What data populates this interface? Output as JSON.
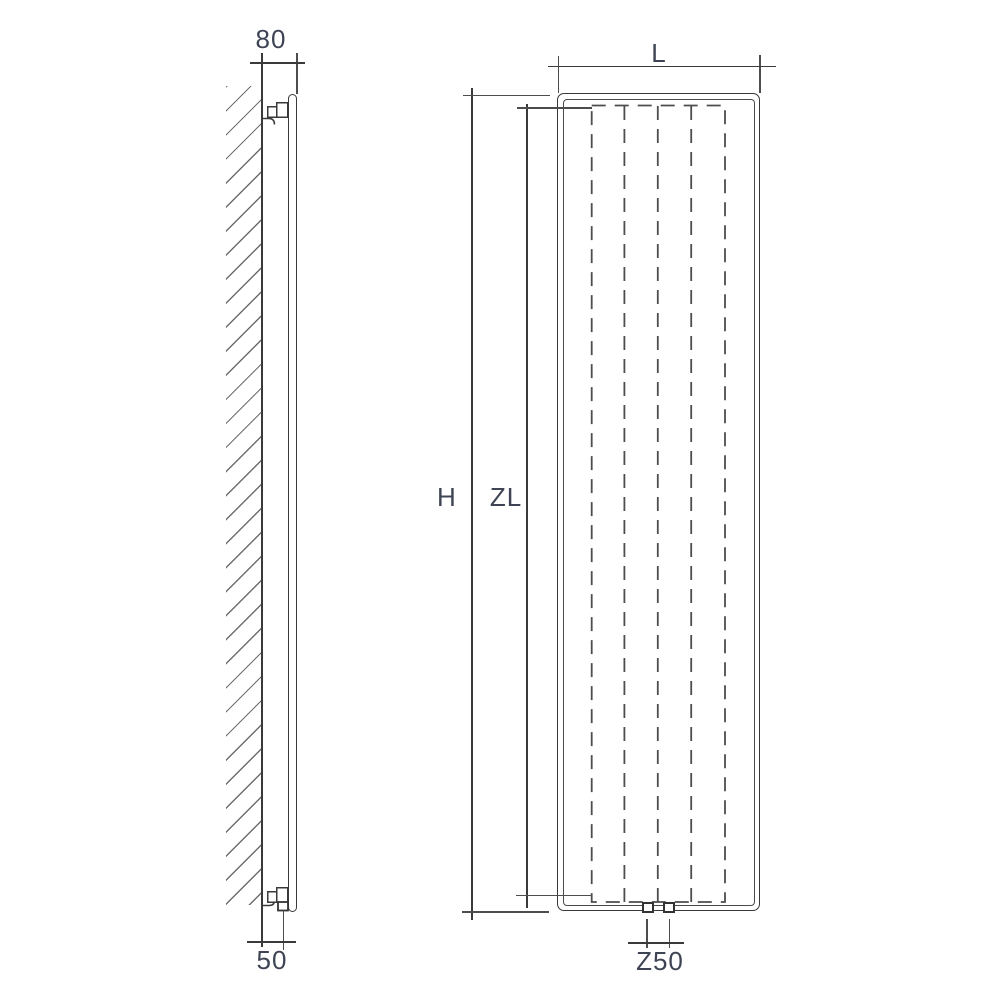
{
  "drawing": {
    "type": "technical-dimension-drawing",
    "subject": "wall-mounted vertical panel radiator, side profile and front elevation",
    "dimensions": {
      "depth": {
        "label": "80"
      },
      "bottom_offset": {
        "label": "50"
      },
      "width": {
        "label": "L"
      },
      "height": {
        "label": "H"
      },
      "inner_height": {
        "label": "ZL"
      },
      "pipe_spacing": {
        "label": "Z50"
      }
    },
    "colors": {
      "line": "#3a3a3a",
      "dashed_line": "#4d4d4d",
      "hatch": "#6e6e6e",
      "label_text": "#3e4454",
      "background": "#ffffff"
    }
  }
}
